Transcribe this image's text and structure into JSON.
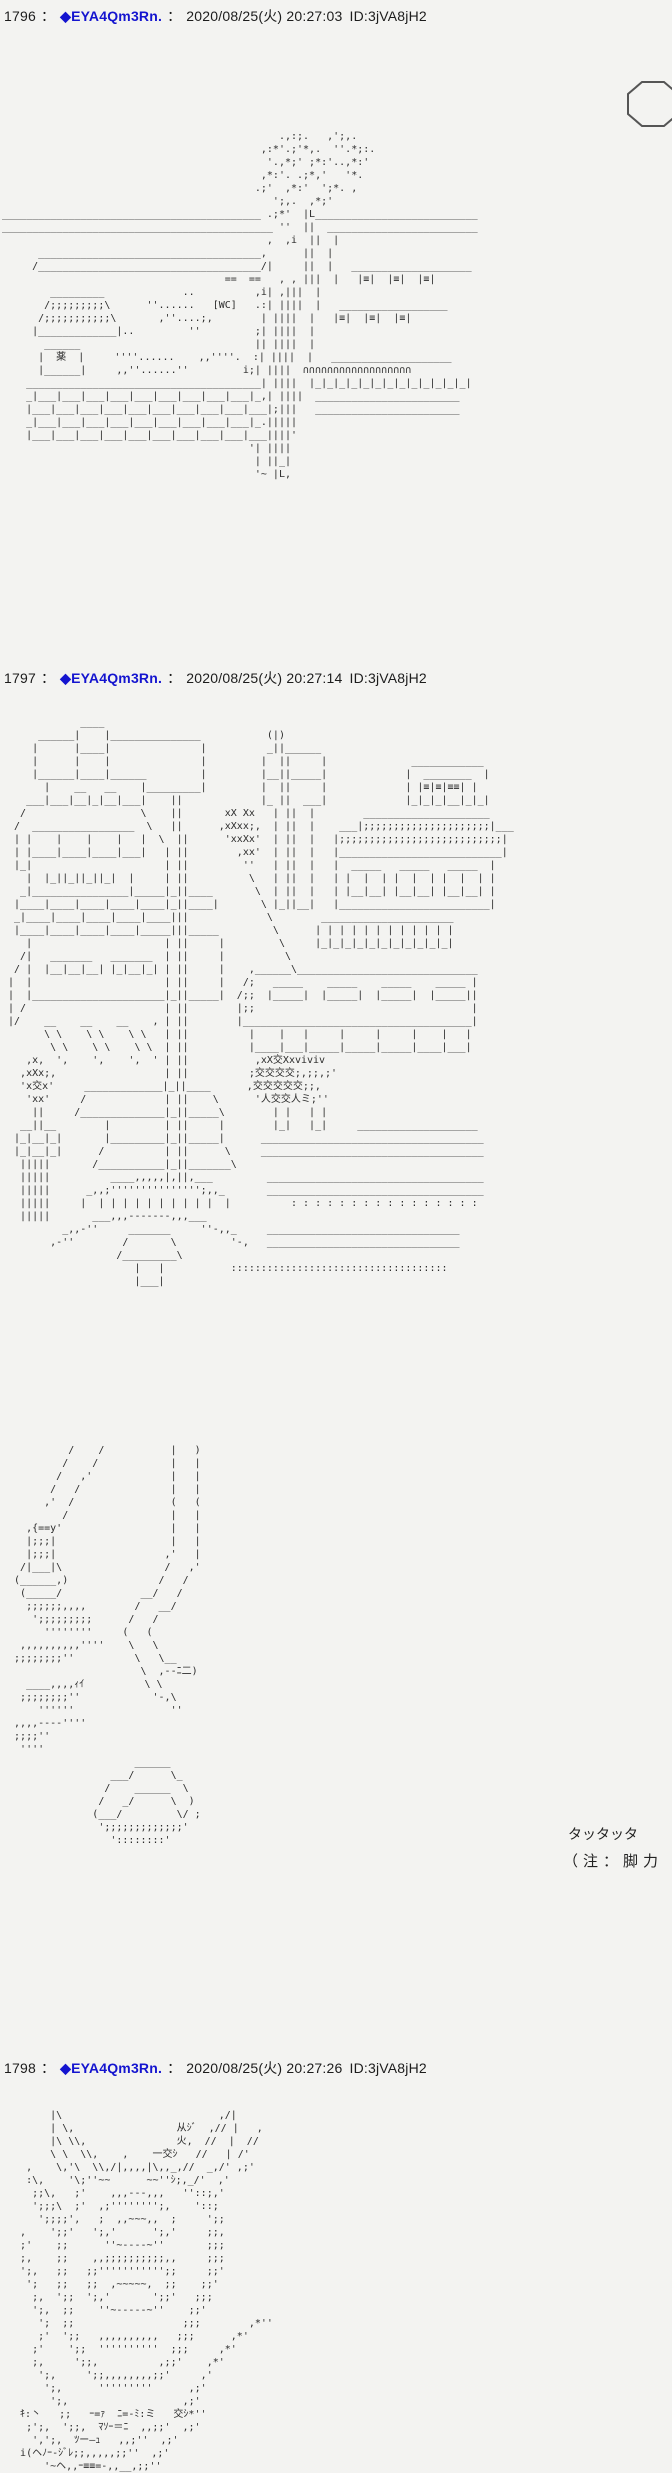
{
  "meta": {
    "bg_color": "#f3f3f1",
    "text_color": "#1c1c1c",
    "name_color": "#1414cf"
  },
  "separator": "：",
  "posts": [
    {
      "number": "1796",
      "name": "◆EYA4Qm3Rn.",
      "date": "2020/08/25(火) 20:27:03",
      "id": "ID:3jVA8jH2",
      "aa": [
        "",
        "",
        "                                              .,:;.   ,';,.",
        "                                           ,:*'.;'*,.  ''.*;:.",
        "                                            '.,*;' ;*:'..,*:'",
        "                                           ,*:'. .;*,'   '*.",
        "                                          .;'  ,*:'  ';*. ,",
        "                                             ';,.  ,*;'",
        "___________________________________________ .;*'  |L___________________________",
        "_____________________________________________ ''  ||  _________________________",
        "                                            ,  ,i  ||  |",
        "      _____________________________________,      ||  |",
        "     /_____________________________________/|     ||  |   ____________________",
        "                                     ==  ==   , , |||  |   |≡|  |≡|  |≡|",
        "        _________             ..          ,i| ,|||  |",
        "       /;;;;;;;;;\\      ''......   [WC]   .:| ||||  |   __________________",
        "      /;;;;;;;;;;;\\       ,''....;,        | ||||  |   |≡|  |≡|  |≡|",
        "     |_____________|..         ''         ;| ||||  |",
        "       ______                             || ||||  |",
        "      |  薬  |     ''''......    ,,''''.  :| ||||  |   ____________________",
        "      |______|     ,,''......''         i;| ||||  ∩∩∩∩∩∩∩∩∩∩∩∩∩∩∩∩∩∩",
        "    _______________________________________| ||||  |_|_|_|_|_|_|_|_|_|_|_|_|_|",
        "    _|___|___|___|___|___|___|___|___|___|_,| ||||  ________________________",
        "    |___|___|___|___|___|___|___|___|___|___|;|||   ________________________",
        "    _|___|___|___|___|___|___|___|___|___|_.|||||",
        "    |___|___|___|___|___|___|___|___|___|___||||'",
        "                                         '| ||||",
        "                                          | ||_|",
        "                                          '~ |L,",
        ""
      ]
    },
    {
      "number": "1797",
      "name": "◆EYA4Qm3Rn.",
      "date": "2020/08/25(火) 20:27:14",
      "id": "ID:3jVA8jH2",
      "sfx": "タッタッタ",
      "note": "（注：脚力",
      "aa": [
        "             ____",
        "      ______|    |_______________           (|)",
        "     |      |____|               |          _||______",
        "     |      |    |               |         |  ||     |              ____________",
        "     |______|____|______         |         |__||_____|             |  ________  |",
        "       |    __   __    |_________|         |  ||     |             | |≡|≡|≡≡| |",
        "    ___|___|__|_|__|___|    ||             |_ ||  ___|             |_|_|_|__|_|_|",
        "   /                   \\    ||       xX Xx   | ||  |        _____________________",
        "  /  _________________  \\   ||      ,xXxx;,  | ||  |    ___|;;;;;;;;;;;;;;;;;;;;;|___",
        "  | |    |    |    |   |  \\  ||      'xxXx'  | ||  |   |;;;;;;;;;;;;;;;;;;;;;;;;;;;|",
        "  | |____|____|____|___|   | ||        ,xx'  | ||  |   |___________________________|",
        "  |_|                      | ||         ''   | ||  |   |  _____   _____   _____  |",
        "    |  |_||_||_||_|  |     | ||          \\   | ||  |   | |  |  | |  |  | |  |  | |",
        "   _|________________|_____|_||____       \\  | ||  |   | |__|__| |__|__| |__|__| |",
        "  |____|____|____|____|____|_||____|       \\ |_||__|   |_________________________|",
        "  _|____|____|____|____|____|||             \\        ______________________",
        "  |____|____|____|____|_____|||_____         \\      | | | | | | | | | | | |",
        "    |                      | ||     |         \\     |_|_|_|_|_|_|_|_|_|_|_|",
        "   /|   _______   _______  | ||     |          \\",
        "  / |  |__|__|__| |_|__|_| | ||     |    ,______\\______________________________",
        " |  |                      | ||     |   /;   _____    _____    _____    _____ |",
        " |  |______________________|_||_____|  /;;  |_____|  |_____|  |_____|  |_____||",
        " | /                       | ||        |;;                                    |",
        " |/    __    __    __    , | ||        |______________________________________|",
        "       \\ \\    \\ \\    \\ \\   | ||          |    |   |     |     |     |    |   |",
        "        \\ \\    \\ \\    \\ \\  | ||          |____|___|_____|_____|_____|____|___|",
        "    ,x,  ',    ',    ',  ' | ||           ,xX交Xxviviv",
        "   ,xXx;,                  | ||          ;交交交交;,;;,;'",
        "   'x交x'     _____________|_||____      ,交交交交交;;,",
        "    'xx'     /             | ||    \\      '人交交人ミ;''",
        "     ||     /______________|_||_____\\        | |   | |",
        "   __||__        |         | ||     |        |_|   |_|     ____________________",
        "  |_|__|_|       |_________|_||_____|      _____________________________________",
        "  |_|__|_|      /          | ||      \\     _____________________________________",
        "   |||||       /___________|_||_______\\",
        "   |||||          ____,,,,,|,||,___         ____________________________________",
        "   |||||      _,,;''''''''''''''';,,_       ____________________________________",
        "   |||||     |  | | | | | | | | | |  |          : : : : : : : : : : : : : : : :",
        "   |||||       ___,,,-------,,,___",
        "          _,,-''     _______     ''-,,_     ________________________________",
        "        ,-''        /       \\         '-,   ________________________________",
        "                   /_________\\",
        "                      |   |           ::::::::::::::::::::::::::::::::::::",
        "                      |___|",
        "",
        "",
        "",
        "",
        "",
        "",
        "",
        "",
        "",
        "",
        "",
        "",
        "           /    /           |   )",
        "          /    /            |   |",
        "         /   ,'             |   |",
        "        /   /               |   |",
        "       ,'  /                (   (",
        "          /                 |   |",
        "    ,{==y'                  |   |",
        "    |;;;|                   |   |",
        "    |;;;|                  ,'   |",
        "   /|___|\\                 /   ,'",
        "  (______,)               /   /",
        "   (_____/             __/   /",
        "    ;;;;;;,,,,        /   __/",
        "     ';;;;;;;;;      /   /",
        "       ''''''''     (   (",
        "   ,,,,,,,,,,''''    \\   \\",
        "  ;;;;;;;;''          \\   \\__",
        "                       \\  ,--ﾆ二)",
        "    ____,,,,ｨｲ          \\ \\",
        "   ;;;;;;;;''            '-,\\",
        "      ''''''                ''",
        "  ,,,,----''''",
        "  ;;;;''",
        "   ''''",
        "                      ______",
        "                  ___/      \\_",
        "                 /    ______  \\",
        "                /   _/      \\  )",
        "               (___/         \\/ ;",
        "                ';;;;;;;;;;;;;'",
        "                  '::::::::'",
        "",
        "",
        ""
      ]
    },
    {
      "number": "1798",
      "name": "◆EYA4Qm3Rn.",
      "date": "2020/08/25(火) 20:27:26",
      "id": "ID:3jVA8jH2",
      "aa": [
        "",
        "        |\\                          ,/|",
        "        | \\,                 从ｼﾞ  ,// |   ,",
        "        |\\ \\\\,               火,  //  |  //",
        "        \\ \\  \\\\,    ,    一交ｼ   //   | /'",
        "    ,    \\,'\\  \\\\,/|,,,,|\\,,_,//  _,/' ,;'",
        "    :\\,    '\\;''~~      ~~''ｼ;,_/'  ,'",
        "     ;;\\,   ;'    ,,,---,,,   ''::;,'",
        "     ';;;\\  ;'  ,;'''''''';,    '::;",
        "      ';;;;',   ;  ,,~~~,,  ;     ';;",
        "   ,    ';;'   ';,'      ';,'     ;;,",
        "   ;'    ;;      ''~----~''       ;;;",
        "   ;,    ;;    ,,;;;;;;;;;;,,     ;;;",
        "   ';,   ;;   ;;''''''''''';;     ;;'",
        "    ';   ;;   ;;  ,~~~~~,  ;;    ;;'",
        "     ;,  ';;  ';,'       ';;'   ;;;",
        "     ';,  ;;    ''~-----~''    ;;'",
        "      ';  ;;                  ;;;        ,*''",
        "      ;'  ';;   ,,,,,,,,,,   ;;;      ,*'",
        "     ;'    ';;  ''''''''''  ;;;     ,*'",
        "     ;,     ';;,          ,;;'    ,*'",
        "      ';,     ';;,,,,,,,,;;'     ,'",
        "       ';,      '''''''''      ,;'",
        "        ';,                   ,;'",
        "   ｷ:丶   ;;   ｰ=ｧ  ﾆ=-ﾐ:ミ   交ｼ*''",
        "    ;';,  ';;,  ﾏｿｰ＝ﾆ  ,,;;'  ,;'",
        "     ',';,  ﾂー―ｭ   ,,;''  ,;'",
        "   i(ヘﾉｰ-ｼﾞﾚ;;,,,,,;;''  ,;'",
        "       '~ヘ,,ｰ≡≡=-,,__,;;''"
      ]
    }
  ]
}
